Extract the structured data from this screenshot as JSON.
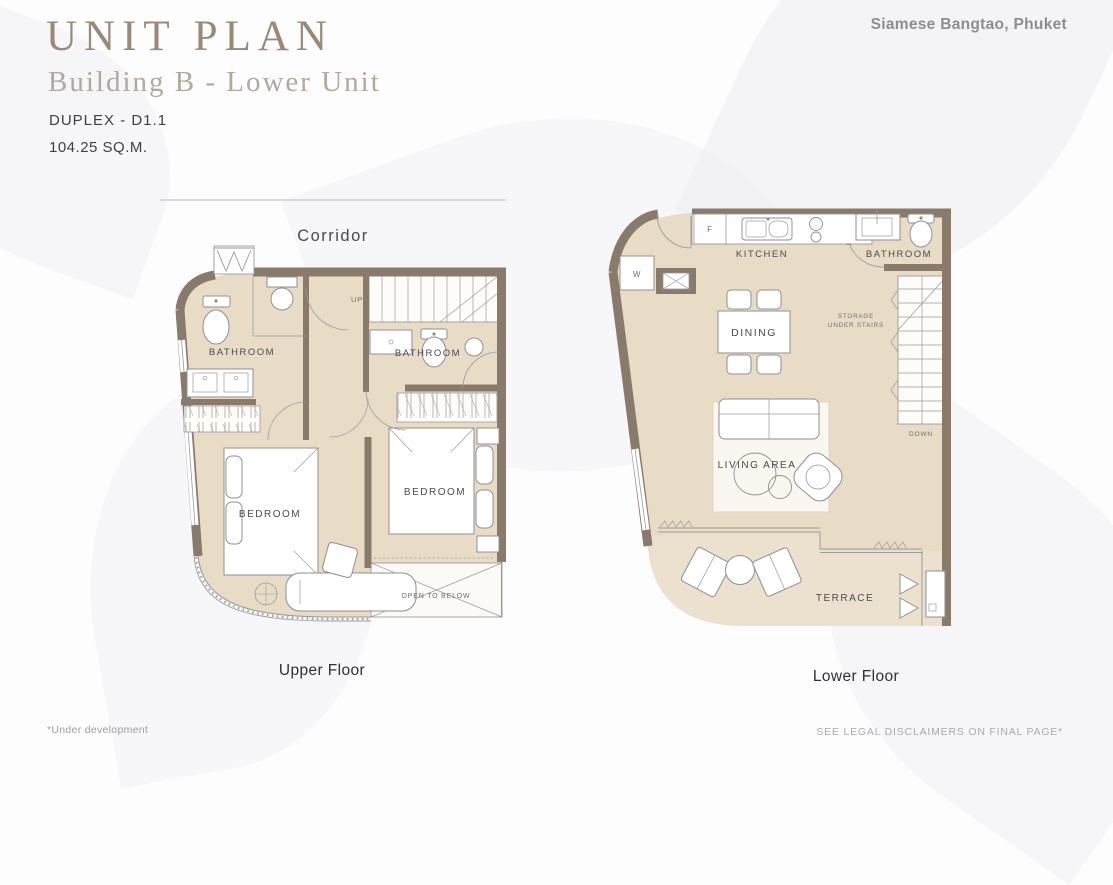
{
  "header": {
    "title": "UNIT PLAN",
    "subtitle": "Building B - Lower Unit",
    "unit_code": "DUPLEX - D1.1",
    "unit_area": "104.25 SQ.M.",
    "project": "Siamese Bangtao, Phuket"
  },
  "upper_floor": {
    "caption": "Upper Floor",
    "corridor": "Corridor",
    "labels": {
      "bathroom_left": "BATHROOM",
      "bathroom_right": "BATHROOM",
      "bedroom_left": "BEDROOM",
      "bedroom_right": "BEDROOM",
      "open_to_below": "OPEN TO BELOW",
      "up": "UP"
    }
  },
  "lower_floor": {
    "caption": "Lower Floor",
    "labels": {
      "kitchen": "KITCHEN",
      "bathroom": "BATHROOM",
      "dining": "DINING",
      "storage_line1": "STORAGE",
      "storage_line2": "UNDER STAIRS",
      "living_area": "LIVING AREA",
      "terrace": "TERRACE",
      "down": "DOWN",
      "washer": "W",
      "fridge": "F"
    }
  },
  "footer": {
    "left_note": "*Under development",
    "right_note": "SEE LEGAL DISCLAIMERS ON FINAL PAGE*"
  },
  "colors": {
    "wall": "#8a7a6b",
    "floor": "#e8dcc6",
    "terrace_floor": "#ebe1ce",
    "title": "#9b8977",
    "subtitle": "#b2a89d",
    "text_dark": "#3f3f45",
    "text_muted": "#8d8d90",
    "line": "#9a9a9e"
  }
}
